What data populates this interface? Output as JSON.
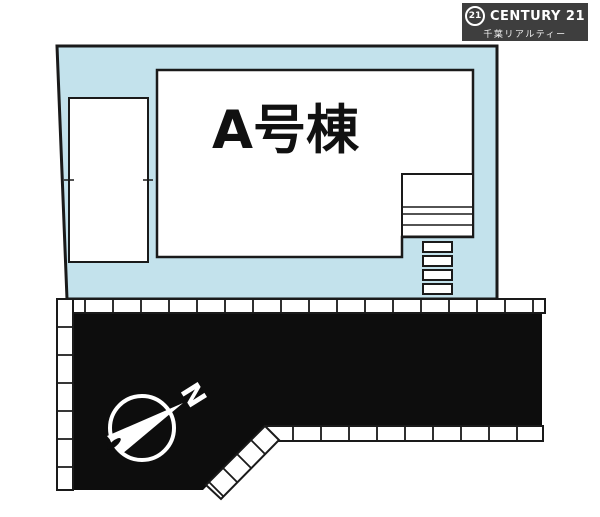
{
  "logo": {
    "seal": "21",
    "brand": "CENTURY 21",
    "subtitle": "千葉リアルティー",
    "bg_color": "#3e3e3e",
    "text_color": "#ffffff"
  },
  "plan": {
    "building_label": "A号棟",
    "north_label": "N",
    "colors": {
      "lot_fill": "#c3e2ec",
      "road_fill": "#0d0d0d",
      "line": "#1a1a1a",
      "paper": "#ffffff"
    }
  }
}
